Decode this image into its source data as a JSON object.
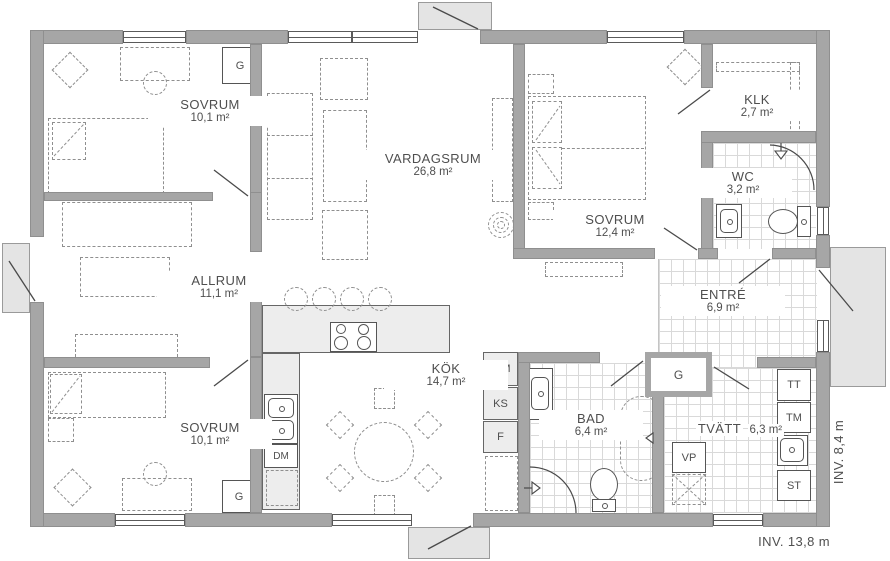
{
  "rooms": {
    "sovrum_nw": {
      "name": "SOVRUM",
      "area": "10,1 m²"
    },
    "vardagsrum": {
      "name": "VARDAGSRUM",
      "area": "26,8 m²"
    },
    "sovrum_e": {
      "name": "SOVRUM",
      "area": "12,4 m²"
    },
    "klk": {
      "name": "KLK",
      "area": "2,7 m²"
    },
    "wc": {
      "name": "WC",
      "area": "3,2 m²"
    },
    "entre": {
      "name": "ENTRÉ",
      "area": "6,9 m²"
    },
    "allrum": {
      "name": "ALLRUM",
      "area": "11,1 m²"
    },
    "sovrum_sw": {
      "name": "SOVRUM",
      "area": "10,1 m²"
    },
    "kok": {
      "name": "KÖK",
      "area": "14,7 m²"
    },
    "bad": {
      "name": "BAD",
      "area": "6,4 m²"
    },
    "tvatt": {
      "name": "TVÄTT",
      "area": "6,3 m²"
    }
  },
  "closets": {
    "g1": "G",
    "g2": "G",
    "g3": "G"
  },
  "appliances": {
    "um": "U/M",
    "ks": "KS",
    "f": "F",
    "dm": "DM",
    "vp": "VP",
    "tt": "TT",
    "tm": "TM",
    "st": "ST"
  },
  "dimensions": {
    "inner_width": "INV. 13,8 m",
    "inner_height": "INV. 8,4 m"
  },
  "colors": {
    "wall": "#a6a6a6",
    "porch": "#e4e4e4",
    "counter": "#ededed",
    "tile_line": "#d9d9d9",
    "text": "#4f4f4f"
  }
}
